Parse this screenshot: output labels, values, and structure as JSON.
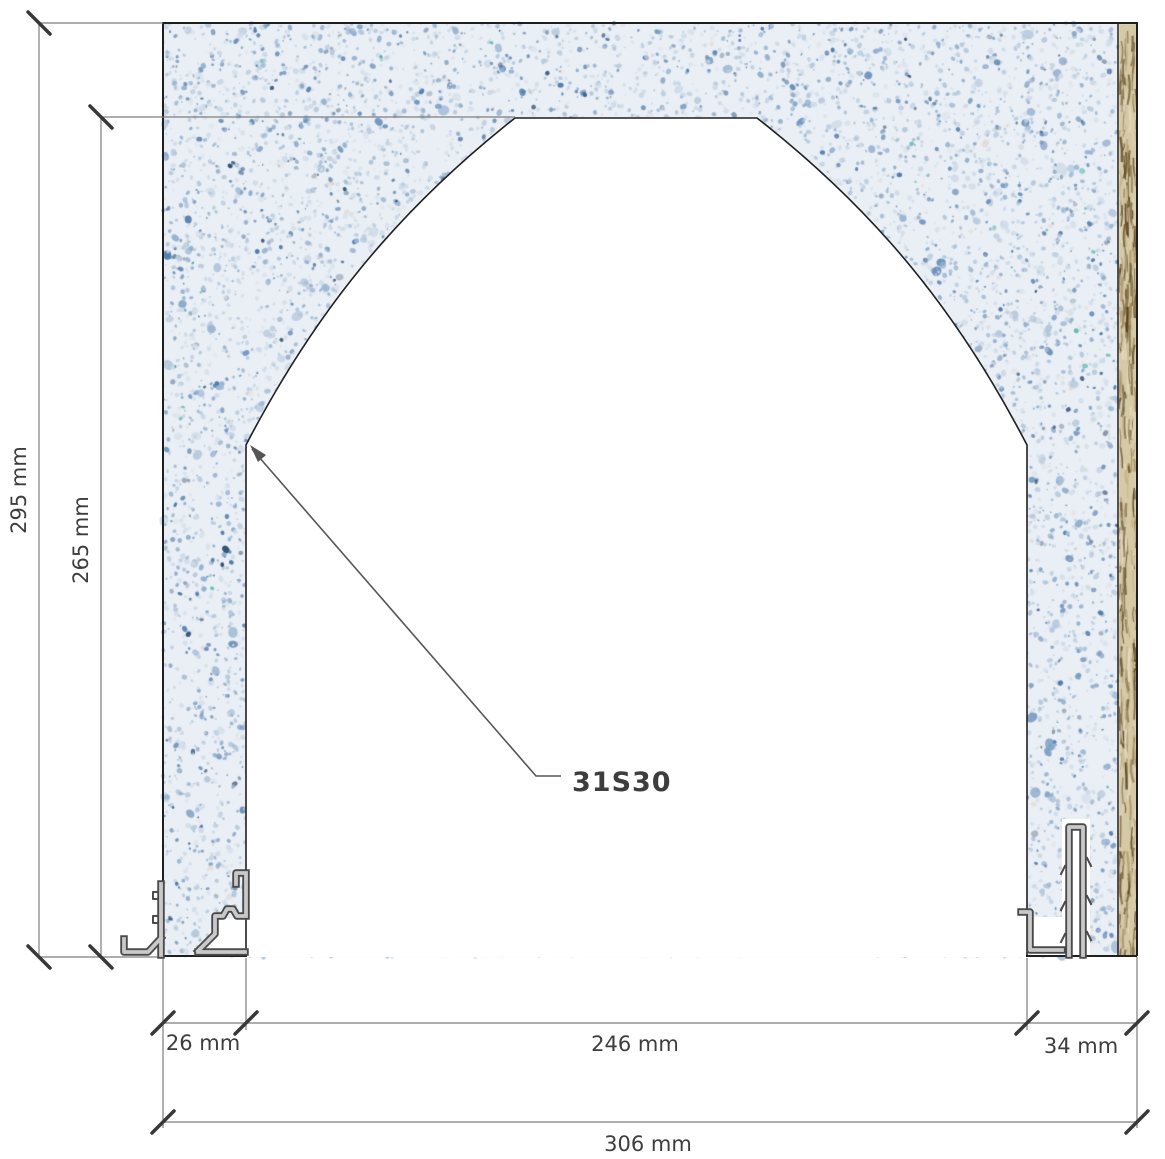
{
  "drawing": {
    "type": "cad-section-arched-opening",
    "label": {
      "text": "31S30"
    },
    "dimensions": {
      "total_height": "295 mm",
      "opening_height": "265 mm",
      "left_jamb_width": "26 mm",
      "opening_width": "246 mm",
      "right_jamb_width": "34 mm",
      "total_width": "306 mm"
    }
  },
  "materials": {
    "foam_base": "#eaeff5",
    "foam_speckles": [
      "#cfdbe8",
      "#b4c8dd",
      "#93b1d0",
      "#6f95bd",
      "#4f7bab",
      "#dfe3e8",
      "#8b99ab",
      "#2f4f76",
      "#e7ddd6",
      "#3fae9e"
    ],
    "osb_base": "#d6c9a6",
    "osb_strands": [
      "#8a734a",
      "#6b5530",
      "#a38c5c",
      "#c3b287",
      "#55421f",
      "#e6dcc2"
    ],
    "line_gray": "#7d7d7d",
    "line_dark": "#383838",
    "outline_black": "#1f1f1f",
    "profile_fill": "#c9c9c9",
    "profile_stroke": "#4a4a4a",
    "leader_color": "#555555",
    "text_color": "#3d3d3d"
  }
}
